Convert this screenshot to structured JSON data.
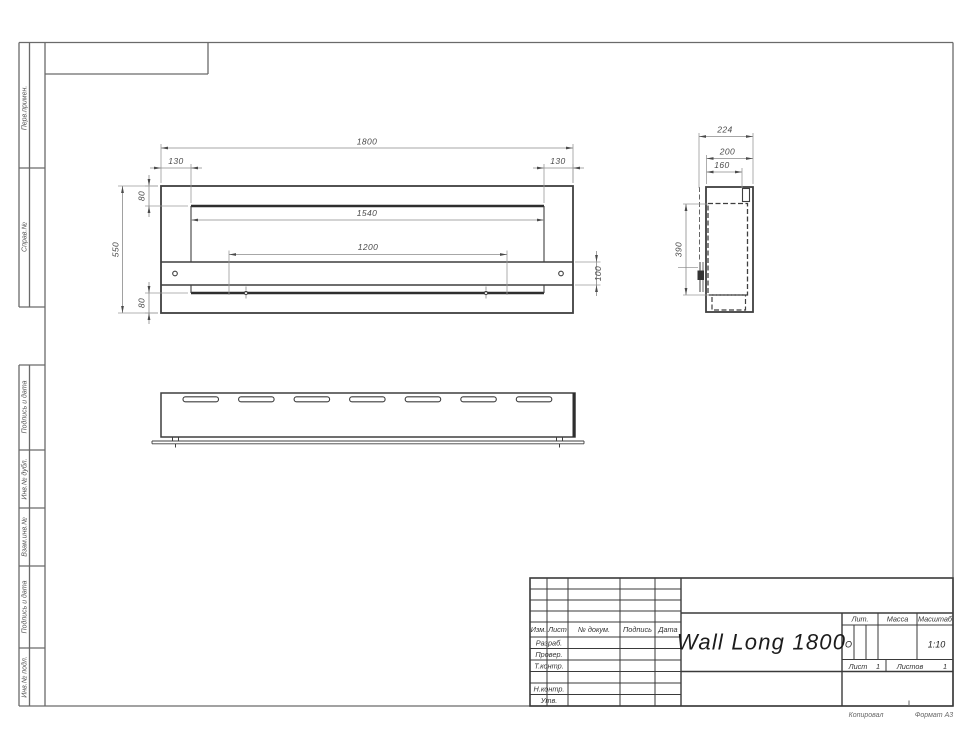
{
  "sidebar": {
    "top_labels": [
      "Перв.примен.",
      "Справ.№"
    ],
    "bottom_labels": [
      "Подпись и дата",
      "Инв.№ дубл.",
      "Взам.инв.№",
      "Подпись и дата",
      "Инв.№ подл."
    ]
  },
  "title_block": {
    "title": "Wall Long 1800",
    "header_cols": [
      "Изм.",
      "Лист",
      "№ докум.",
      "Подпись",
      "Дата"
    ],
    "sign_rows": [
      "Разраб.",
      "Провер.",
      "Т.контр.",
      "Н.контр.",
      "Утв."
    ],
    "lit_label": "Лит.",
    "lit_value": "О",
    "mass_label": "Масса",
    "scale_label": "Масштаб",
    "scale_value": "1:10",
    "sheet_label": "Лист",
    "sheet_value": "1",
    "sheets_label": "Листов",
    "sheets_value": "1"
  },
  "footer": {
    "copied": "Копировал",
    "format": "Формат А3"
  },
  "drawing": {
    "dims": {
      "front_overall_width": "1800",
      "front_left_offset": "130",
      "front_right_offset": "130",
      "front_top_margin": "80",
      "front_height": "550",
      "front_bottom_margin": "80",
      "front_opening_width": "1540",
      "front_mount_spacing": "1200",
      "front_bar_height": "100",
      "side_overall_depth": "224",
      "side_body_depth": "200",
      "side_top_depth": "160",
      "side_inner_height": "390"
    },
    "bottom_view": {
      "slot_count": 7
    }
  }
}
